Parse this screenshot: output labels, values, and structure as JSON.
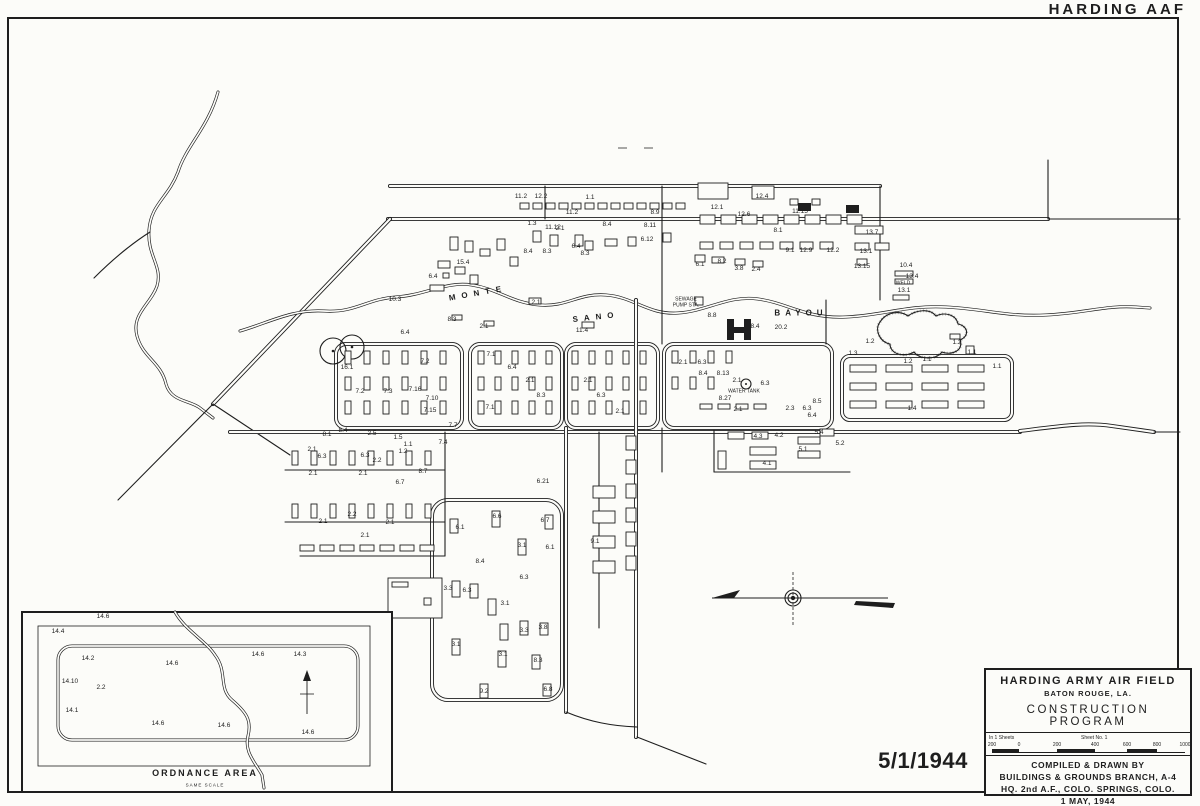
{
  "page": {
    "corner_label": "HARDING AAF",
    "date_stamp": "5/1/1944"
  },
  "map": {
    "bayou": {
      "word1": "MONTE",
      "word2": "SANO",
      "word3": "BAYOU"
    },
    "labels": [
      [
        521,
        197,
        "11.2"
      ],
      [
        541,
        197,
        "12.2"
      ],
      [
        590,
        198,
        "1.1"
      ],
      [
        572,
        213,
        "11.2"
      ],
      [
        717,
        208,
        "12.1"
      ],
      [
        762,
        197,
        "12.4"
      ],
      [
        800,
        212,
        "11.15"
      ],
      [
        744,
        215,
        "12.6"
      ],
      [
        778,
        231,
        "8.1"
      ],
      [
        790,
        251,
        "9.1"
      ],
      [
        806,
        251,
        "12.9"
      ],
      [
        833,
        251,
        "12.2"
      ],
      [
        872,
        233,
        "13.7"
      ],
      [
        866,
        252,
        "13.1"
      ],
      [
        862,
        267,
        "13.15"
      ],
      [
        912,
        277,
        "13.4"
      ],
      [
        906,
        266,
        "10.4"
      ],
      [
        903,
        284,
        "WELD",
        1
      ],
      [
        904,
        291,
        "13.1"
      ],
      [
        655,
        213,
        "8.9"
      ],
      [
        650,
        226,
        "8.11"
      ],
      [
        532,
        224,
        "1.3"
      ],
      [
        553,
        228,
        "11.12"
      ],
      [
        560,
        229,
        "2.1"
      ],
      [
        607,
        225,
        "8.4"
      ],
      [
        647,
        240,
        "6.12"
      ],
      [
        576,
        247,
        "6.4"
      ],
      [
        585,
        254,
        "8.3"
      ],
      [
        528,
        252,
        "8.4"
      ],
      [
        547,
        252,
        "8.3"
      ],
      [
        700,
        265,
        "6.1"
      ],
      [
        722,
        262,
        "8.2"
      ],
      [
        739,
        269,
        "3.8"
      ],
      [
        756,
        270,
        "2.4"
      ],
      [
        433,
        277,
        "6.4"
      ],
      [
        463,
        263,
        "15.4"
      ],
      [
        395,
        300,
        "10.3"
      ],
      [
        536,
        303,
        "2.1"
      ],
      [
        484,
        327,
        "2.1"
      ],
      [
        452,
        320,
        "8.3"
      ],
      [
        582,
        331,
        "11.4"
      ],
      [
        686,
        300,
        "SEWAGE",
        1
      ],
      [
        686,
        306,
        "PUMP STA.",
        1
      ],
      [
        712,
        316,
        "8.8"
      ],
      [
        755,
        327,
        "8.4"
      ],
      [
        781,
        328,
        "20.2"
      ],
      [
        347,
        368,
        "16.1"
      ],
      [
        425,
        362,
        "7.2"
      ],
      [
        405,
        333,
        "6.4"
      ],
      [
        360,
        392,
        "7.2"
      ],
      [
        388,
        392,
        "7.3"
      ],
      [
        415,
        390,
        "7.16"
      ],
      [
        432,
        399,
        "7.10"
      ],
      [
        430,
        411,
        "7.15"
      ],
      [
        490,
        408,
        "7.1"
      ],
      [
        491,
        355,
        "7.1"
      ],
      [
        453,
        426,
        "7.7"
      ],
      [
        443,
        443,
        "7.4"
      ],
      [
        512,
        368,
        "6.4"
      ],
      [
        530,
        381,
        "2.1"
      ],
      [
        541,
        396,
        "8.3"
      ],
      [
        588,
        381,
        "2.1"
      ],
      [
        601,
        396,
        "6.3"
      ],
      [
        620,
        412,
        "2.1"
      ],
      [
        683,
        363,
        "2.1"
      ],
      [
        702,
        363,
        "6.3"
      ],
      [
        703,
        374,
        "8.4"
      ],
      [
        723,
        374,
        "8.13"
      ],
      [
        737,
        381,
        "2.1"
      ],
      [
        744,
        392,
        "WATER TANK",
        1
      ],
      [
        725,
        399,
        "8.27"
      ],
      [
        738,
        410,
        "2.1"
      ],
      [
        765,
        384,
        "6.3"
      ],
      [
        790,
        409,
        "2.3"
      ],
      [
        807,
        409,
        "6.3"
      ],
      [
        817,
        402,
        "8.5"
      ],
      [
        812,
        416,
        "6.4"
      ],
      [
        870,
        342,
        "1.2"
      ],
      [
        853,
        354,
        "1.3"
      ],
      [
        908,
        362,
        "1.2"
      ],
      [
        927,
        360,
        "1.1"
      ],
      [
        957,
        343,
        "1.2"
      ],
      [
        972,
        353,
        "1.1"
      ],
      [
        997,
        367,
        "1.1"
      ],
      [
        912,
        409,
        "1.4"
      ],
      [
        327,
        435,
        "8.1"
      ],
      [
        343,
        431,
        "8.4"
      ],
      [
        372,
        434,
        "2.5"
      ],
      [
        398,
        438,
        "1.5"
      ],
      [
        408,
        445,
        "1.1"
      ],
      [
        403,
        452,
        "1.2"
      ],
      [
        312,
        450,
        "2.1"
      ],
      [
        322,
        457,
        "6.3"
      ],
      [
        365,
        456,
        "6.3"
      ],
      [
        377,
        461,
        "2.2"
      ],
      [
        313,
        474,
        "2.1"
      ],
      [
        363,
        474,
        "2.1"
      ],
      [
        423,
        472,
        "8.7"
      ],
      [
        400,
        483,
        "6.7"
      ],
      [
        323,
        522,
        "2.1"
      ],
      [
        390,
        523,
        "2.1"
      ],
      [
        352,
        515,
        "2.2"
      ],
      [
        365,
        536,
        "2.1"
      ],
      [
        543,
        482,
        "6.21"
      ],
      [
        497,
        517,
        "6.6"
      ],
      [
        545,
        521,
        "6.7"
      ],
      [
        460,
        528,
        "6.1"
      ],
      [
        522,
        546,
        "3.1"
      ],
      [
        550,
        548,
        "6.1"
      ],
      [
        595,
        542,
        "9.1"
      ],
      [
        480,
        562,
        "8.4"
      ],
      [
        448,
        589,
        "3.3"
      ],
      [
        467,
        591,
        "6.3"
      ],
      [
        524,
        578,
        "6.3"
      ],
      [
        505,
        604,
        "3.1"
      ],
      [
        524,
        631,
        "3.3"
      ],
      [
        543,
        628,
        "3.8"
      ],
      [
        503,
        655,
        "3.1"
      ],
      [
        456,
        645,
        "3.1"
      ],
      [
        538,
        661,
        "8.3"
      ],
      [
        548,
        690,
        "6.8"
      ],
      [
        484,
        692,
        "9.2"
      ],
      [
        758,
        437,
        "4.3"
      ],
      [
        779,
        436,
        "4.2"
      ],
      [
        819,
        433,
        "5.4"
      ],
      [
        840,
        444,
        "5.2"
      ],
      [
        803,
        450,
        "5.1"
      ],
      [
        767,
        464,
        "4.1"
      ]
    ]
  },
  "inset": {
    "title": "ORDNANCE AREA",
    "subtitle": "SAME SCALE",
    "labels": [
      [
        103,
        617,
        "14.6"
      ],
      [
        58,
        632,
        "14.4"
      ],
      [
        88,
        659,
        "14.2"
      ],
      [
        70,
        682,
        "14.10"
      ],
      [
        101,
        688,
        "2.2"
      ],
      [
        72,
        711,
        "14.1"
      ],
      [
        172,
        664,
        "14.6"
      ],
      [
        258,
        655,
        "14.6"
      ],
      [
        300,
        655,
        "14.3"
      ],
      [
        158,
        724,
        "14.6"
      ],
      [
        224,
        726,
        "14.6"
      ],
      [
        308,
        733,
        "14.6"
      ]
    ]
  },
  "title_block": {
    "line1": "HARDING ARMY AIR FIELD",
    "line2": "BATON ROUGE, LA.",
    "line3": "CONSTRUCTION PROGRAM",
    "sheets_left": "In 1 Sheets",
    "sheets_right": "Sheet No. 1",
    "scale_ticks": [
      "200",
      "0",
      "200",
      "400",
      "600",
      "800",
      "1000"
    ],
    "credit1": "COMPILED & DRAWN BY",
    "credit2": "BUILDINGS & GROUNDS BRANCH, A-4",
    "credit3": "HQ. 2nd A.F., COLO. SPRINGS, COLO.",
    "credit4": "1 MAY, 1944"
  },
  "colors": {
    "ink": "#1e1e1e",
    "paper": "#fcfcf9"
  }
}
